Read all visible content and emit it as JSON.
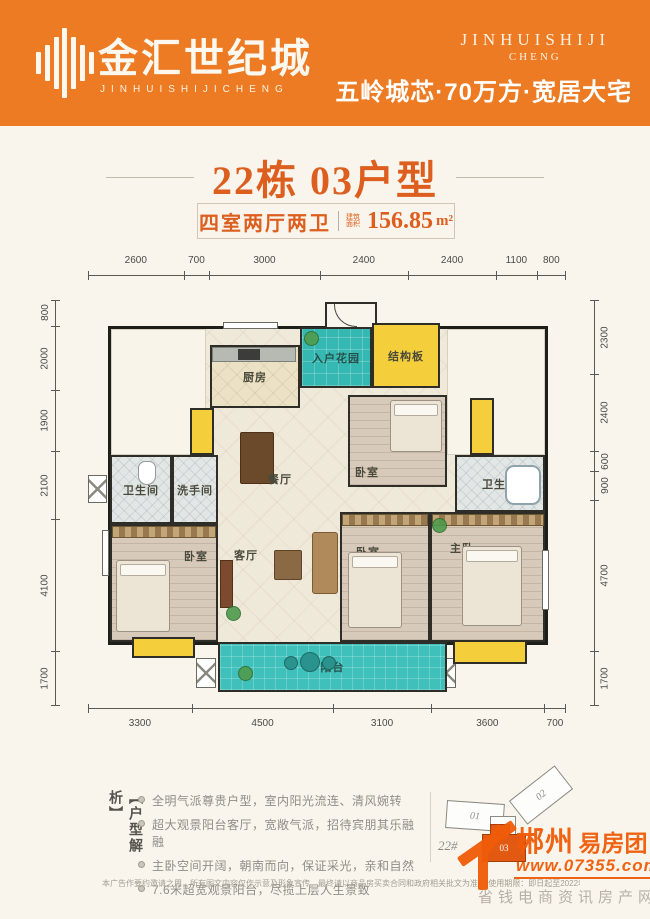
{
  "header": {
    "logo_cn": "金汇世纪城",
    "logo_en": "JINHUISHIJICHENG",
    "brand_en_line1": "JINHUISHIJI",
    "brand_en_line2": "CHENG",
    "tagline": "五岭城芯·70万方·宽居大宅"
  },
  "title": "22栋 03户型",
  "area_box": {
    "layout": "四室两厅两卫",
    "area_label_line1": "建筑",
    "area_label_line2": "面积",
    "area_value": "156.85",
    "area_unit": "m²"
  },
  "floorplan": {
    "dims_top": [
      "2600",
      "700",
      "3000",
      "2400",
      "2400",
      "1100",
      "800"
    ],
    "dims_bottom": [
      "3300",
      "4500",
      "3100",
      "3600",
      "700"
    ],
    "dims_left": [
      "800",
      "2000",
      "1900",
      "2100",
      "4100",
      "1700"
    ],
    "dims_right": [
      "2300",
      "2400",
      "600",
      "900",
      "4700",
      "1700"
    ],
    "rooms": {
      "kitchen": "厨房",
      "entry_garden": "入户花园",
      "structure_slab": "结构板",
      "bedroom_top": "卧室",
      "bathroom_right": "卫生间",
      "master_bedroom": "主卧",
      "bedroom_mid": "卧室",
      "bedroom_left": "卧室",
      "bathroom_left": "卫生间",
      "washroom": "洗手间",
      "dining": "餐厅",
      "living": "客厅",
      "balcony": "阳台"
    }
  },
  "analysis": {
    "vertical_label": "【户型解析】",
    "bullets": [
      "全明气派尊贵户型，室内阳光流连、清风婉转",
      "超大观景阳台客厅，宽敞气派，招待宾朋其乐融融",
      "主卧空间开阔，朝南而向，保证采光，亲和自然",
      "7.6米超宽观景阳台，尽揽上层人生景致"
    ]
  },
  "keyplan": {
    "building_label": "22#",
    "units": [
      "01",
      "02",
      "03"
    ]
  },
  "watermark": {
    "brand_part1": "郴州",
    "brand_part2": "易房团",
    "url": "www.07355.com",
    "slogan": "省钱电商资讯房产网"
  },
  "disclaimer": "本广告作要约邀请之用，所有图文内容仅作示意及形象宣传，最终请以商品房买卖合同和政府相关批文为准。[使用期限：即日起至2022年5月30日]",
  "colors": {
    "header_orange": "#ec7b23",
    "accent_orange": "#dd5f1f",
    "watermark_orange": "#f05c08",
    "garden_teal": "#36b8b2",
    "balcony_teal": "#3fc0ba",
    "slab_yellow": "#f5cf3b"
  }
}
